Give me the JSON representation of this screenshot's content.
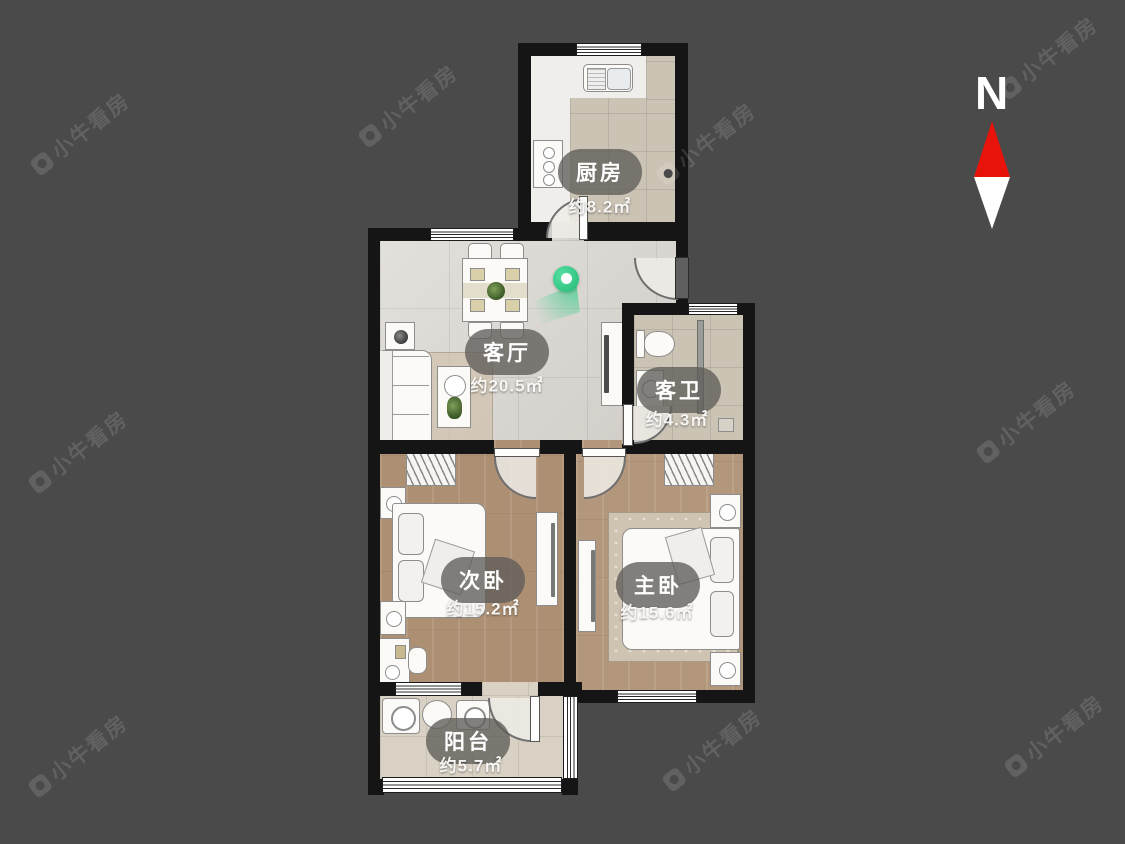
{
  "page": {
    "bg": "#4a4a4a"
  },
  "watermark": {
    "text": "小牛看房"
  },
  "compass": {
    "label": "N",
    "arrow_red": "#e8140c",
    "arrow_white": "#ffffff"
  },
  "rooms": {
    "kitchen": {
      "name": "厨房",
      "area": "约8.2㎡"
    },
    "living": {
      "name": "客厅",
      "area": "约20.5㎡"
    },
    "bathroom": {
      "name": "客卫",
      "area": "约4.3㎡"
    },
    "bedroom2": {
      "name": "次卧",
      "area": "约15.2㎡"
    },
    "bedroom1": {
      "name": "主卧",
      "area": "约15.6㎡"
    },
    "balcony": {
      "name": "阳台",
      "area": "约5.7㎡"
    }
  },
  "colors": {
    "background": "#4a4a4a",
    "wall": "#151515",
    "marble_floor": "#d9d6d0",
    "tile_floor": "#cbc3b4",
    "wood_floor": "#ad9074",
    "pin_green": "#2fd188",
    "compass_red": "#e8140c",
    "label_pill": "#5f5c58"
  }
}
